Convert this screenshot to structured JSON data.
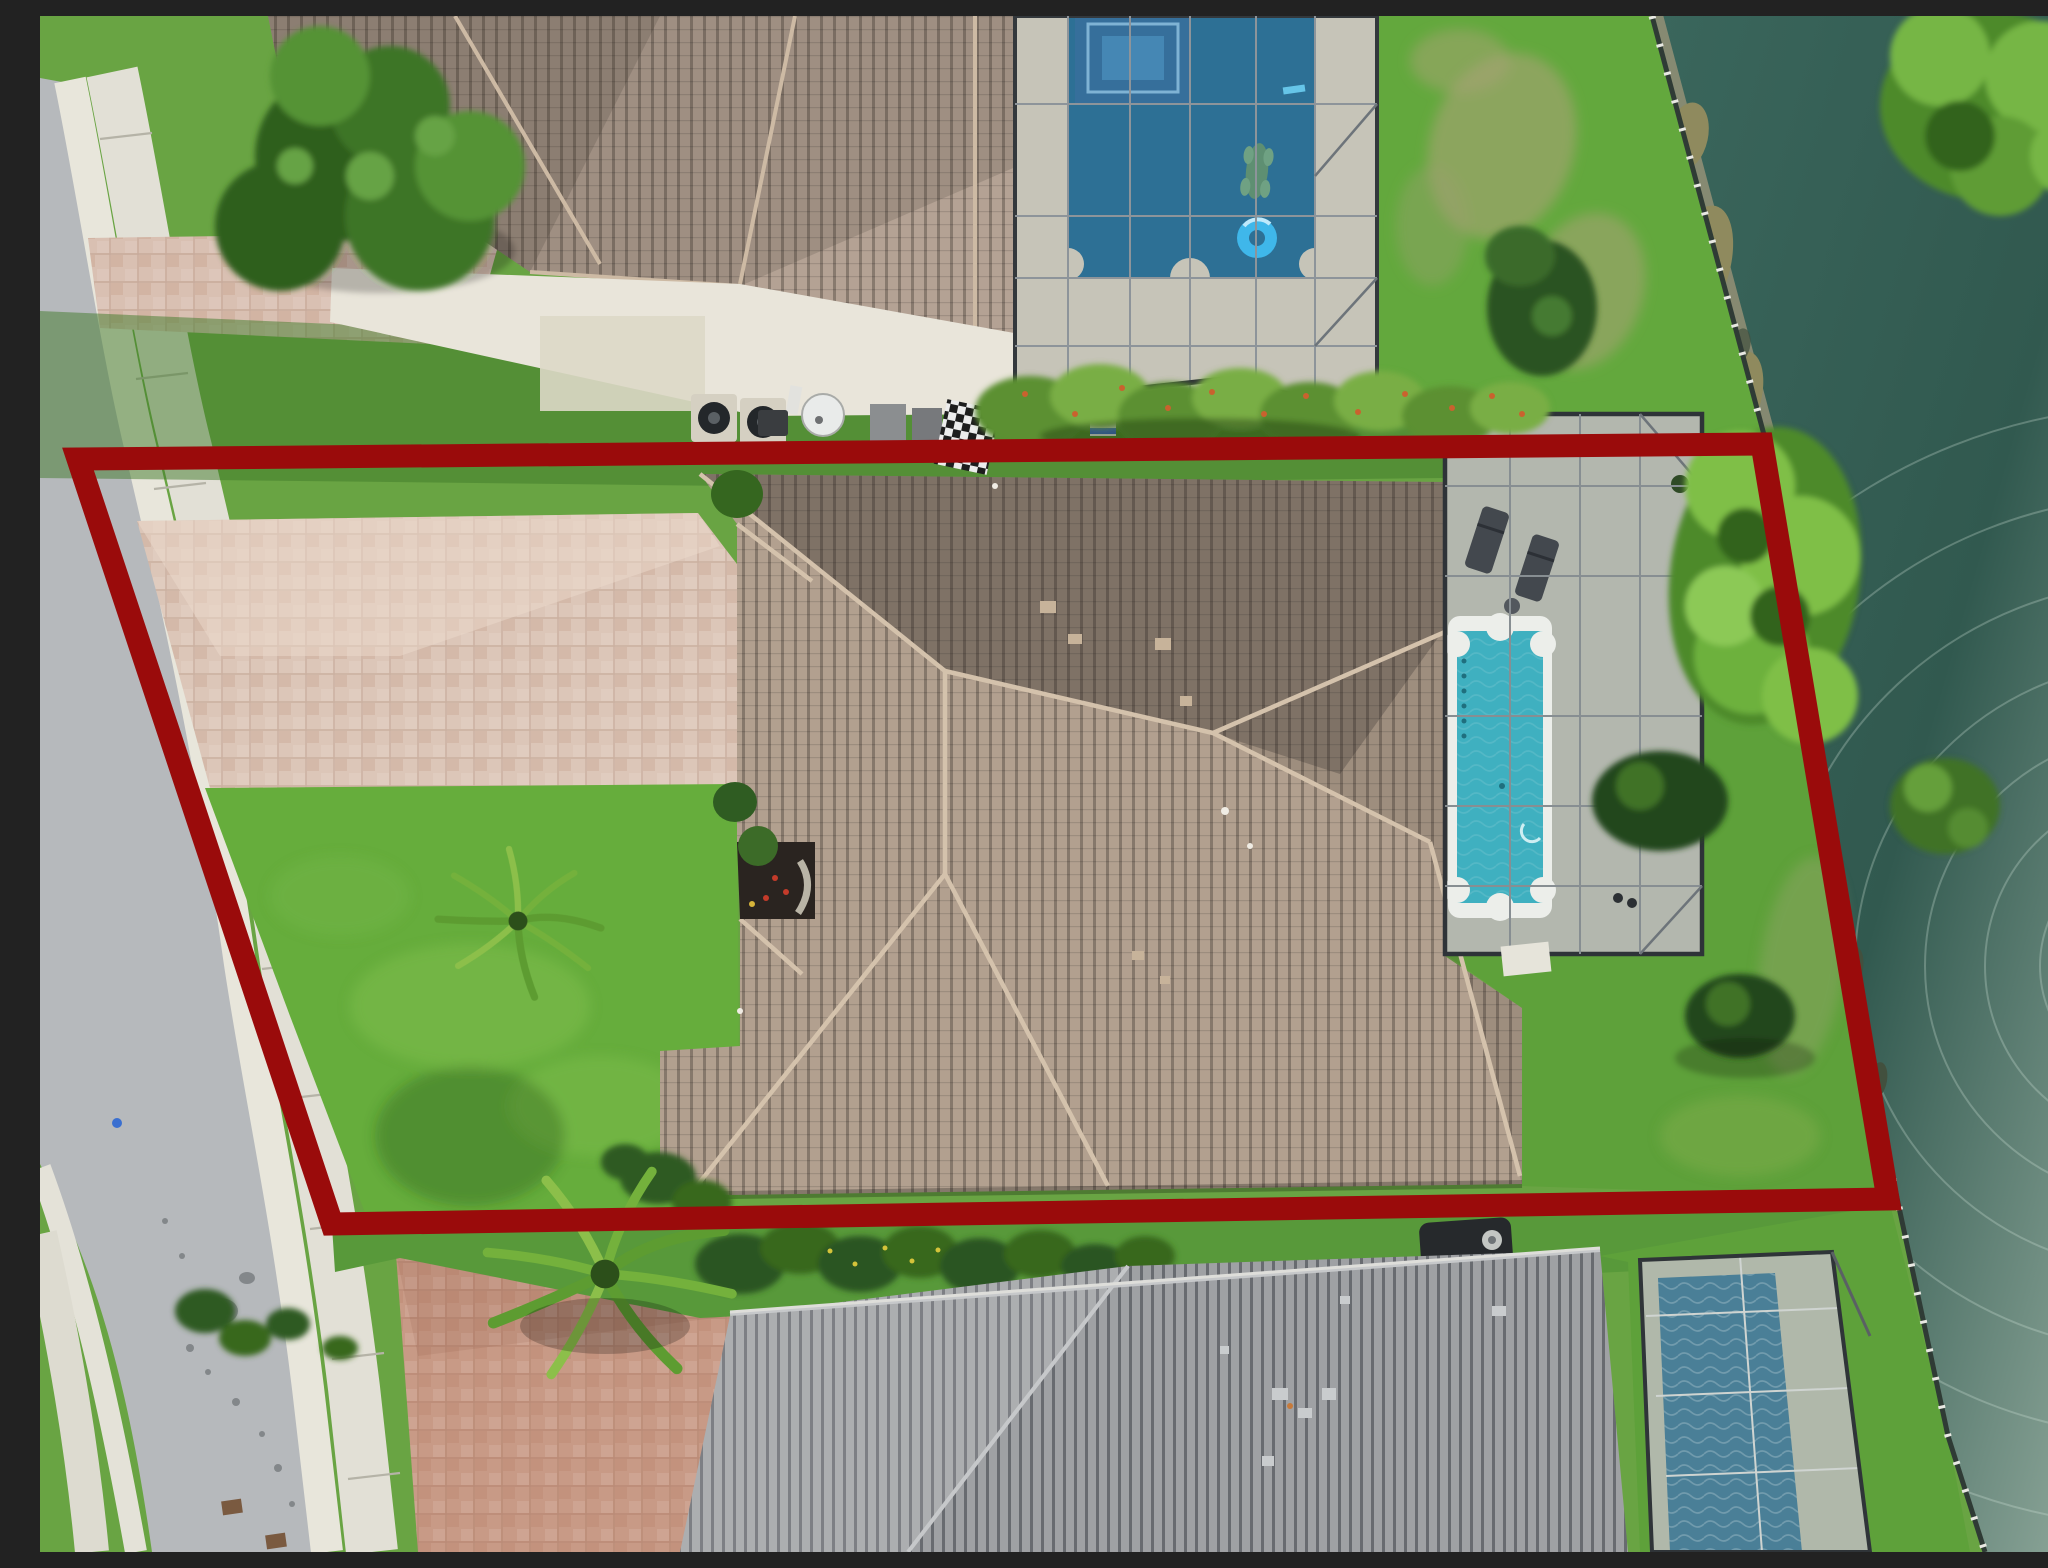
{
  "meta": {
    "caption": "Aerial drone photograph, looking straight down, of a single-family Florida home with a tan tile hip roof, brick-paver driveway and a screened lanai containing a turquoise roman-style pool. A dark red property-boundary outline is drawn around the lot, which fronts a curving street on the left and a dark teal lake with a black shoreline fence on the right. Neighboring houses with their own screened pools sit above and below the lot."
  },
  "boundary": {
    "points": "38,443 1722,428 1848,1183 292,1208",
    "color": "#9a0b0b",
    "stroke_width": 23
  },
  "palette": {
    "grass": "#69a443",
    "grass_dark": "#3f7a2a",
    "grass_front": "#66ad3c",
    "asphalt": "#b6b9bc",
    "concrete": "#e2e0d6",
    "gutter": "#e8e6db",
    "paver_upper": "#d9c0b2",
    "paver_light": "#dcc6b8",
    "paver_rich": "#c89a86",
    "roof_main": "#b2a08f",
    "roof_top_house": "#b4a294",
    "roof_bottom_house": "#9fa1a4",
    "lanai_deck": "#c4c6bb",
    "top_deck": "#c6c4b8",
    "pool_main": "#3fb0c0",
    "pool_top": "#2d7095",
    "pool_bottom": "#4a7f97",
    "lake_top": "#3a665c",
    "lake_mid": "#31594f",
    "lake_glare": "#8fa89b",
    "enclosure_frame": "#2e3338",
    "ridge_cap": "#d4c2ac"
  },
  "features": [
    {
      "name": "property-boundary",
      "kind": "overlay-outline"
    },
    {
      "name": "subject-house-roof",
      "kind": "tile-hip-roof"
    },
    {
      "name": "screened-lanai-pool",
      "kind": "pool-enclosure"
    },
    {
      "name": "street",
      "kind": "asphalt-road"
    },
    {
      "name": "sidewalk",
      "kind": "concrete-walk"
    },
    {
      "name": "paver-driveway",
      "kind": "driveway"
    },
    {
      "name": "lake",
      "kind": "water"
    },
    {
      "name": "shoreline-fence",
      "kind": "fence"
    },
    {
      "name": "neighbor-house-top",
      "kind": "house-with-pool"
    },
    {
      "name": "neighbor-house-bottom",
      "kind": "house-with-pool"
    },
    {
      "name": "front-yard-palm",
      "kind": "palm-tree"
    },
    {
      "name": "backyard-trees",
      "kind": "trees"
    }
  ]
}
